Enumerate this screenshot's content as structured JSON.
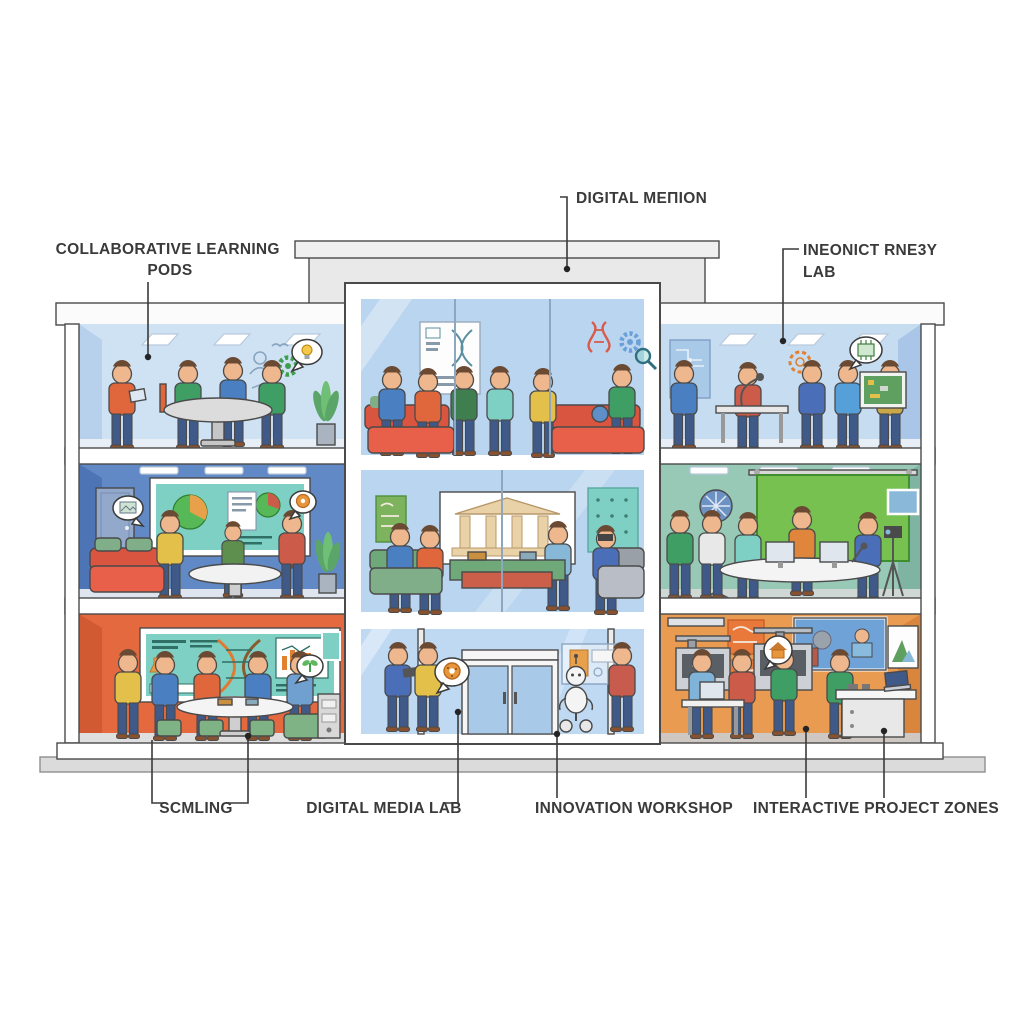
{
  "figure": {
    "type": "building cross-section cutaway illustration of a learning and innovation center",
    "floors": 3
  },
  "labels": {
    "collaborative_learning_pods": {
      "line1": "COLLABORATIVE LEARNING",
      "line2": "PODS"
    },
    "digital_metion": {
      "line1": "DIGITAL MEΠION"
    },
    "ineonict_rne3y_lab": {
      "line1": "INEONICT RNE3Y",
      "line2": "LAB"
    },
    "scmling": {
      "line1": "SCMLING"
    },
    "digital_media_lab": {
      "line1": "DIGITAL MEDIA LAB"
    },
    "innovation_workshop": {
      "line1": "INNOVATION WORKSHOP"
    },
    "interactive_project_zones": {
      "line1": "INTERACTIVE PROJECT ZONES"
    }
  },
  "rooms": [
    {
      "position": "top-left",
      "label": "COLLABORATIVE LEARNING PODS",
      "scene": "students around a round table with tablets, lightbulb speech bubble, gear doodle, potted plant"
    },
    {
      "position": "middle-left",
      "label": "",
      "scene": "presentation lounge with large teal chart screen, red couch, oval table, door, plant"
    },
    {
      "position": "bottom-left",
      "label": "SCMLING",
      "scene": "science room with DNA whiteboard, bar chart, green stools, oval table, sprout speech bubble"
    },
    {
      "position": "center-top",
      "label": "",
      "scene": "glass atrium lounge with red couches, DNA poster, floating gear and magnifier icons"
    },
    {
      "position": "center-middle",
      "label": "",
      "scene": "media lounge with classical museum screen, green consoles, VR headset user"
    },
    {
      "position": "center-bottom",
      "label": "DIGITAL MEDIA LAB / INNOVATION WORKSHOP",
      "scene": "entrance lobby with double glass doors, greeter robot, info panel, donut speech bubble"
    },
    {
      "position": "top-right",
      "label": "INEONICT RNE3Y LAB",
      "scene": "electronics lab with circuit poster, desk rig, gadget users, circuit speech bubble"
    },
    {
      "position": "middle-right",
      "label": "",
      "scene": "video studio with green screen, studio light, dual monitors, camera tripod"
    },
    {
      "position": "bottom-right",
      "label": "INTERACTIVE PROJECT ZONES",
      "scene": "maker space with 3D printers, video wall, workbench, laptop"
    }
  ],
  "colors": {
    "background": "#ffffff",
    "outline": "#4a4a4a",
    "label_text": "#3a3a3a",
    "ground": "#dbdbdb",
    "penthouse": "#e9e9e9",
    "penthouse_cap": "#f0f0f0",
    "roof_band": "#fbfbfb",
    "glass": "#bad5ef",
    "lobby_glass": "#bfd9f3",
    "room_top_left": "#cfe2f4",
    "room_mid_left": "#6089c5",
    "room_bottom_left": "#e5693f",
    "room_top_right": "#c6dcf1",
    "room_mid_right": "#98c8b6",
    "room_bottom_right": "#ea9b52",
    "green_screen": "#76c14f",
    "teal_screen": "#7fd0c4",
    "couch_red": "#e8604a",
    "couch_green": "#7fae88",
    "accent_orange": "#e08030"
  }
}
